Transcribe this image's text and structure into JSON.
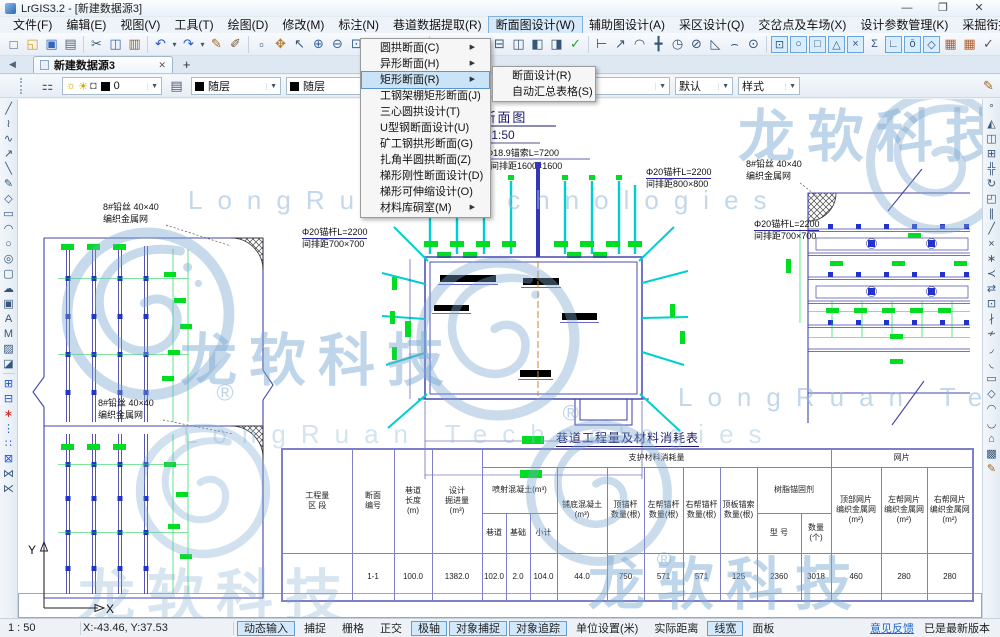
{
  "window": {
    "title": "LrGIS3.2 - [新建数据源3]",
    "min": "—",
    "max": "❐",
    "close": "✕"
  },
  "menubar": [
    {
      "n": "menu-file",
      "label": "文件(F)"
    },
    {
      "n": "menu-edit",
      "label": "编辑(E)"
    },
    {
      "n": "menu-view",
      "label": "视图(V)"
    },
    {
      "n": "menu-tools",
      "label": "工具(T)"
    },
    {
      "n": "menu-draw",
      "label": "绘图(D)"
    },
    {
      "n": "menu-modify",
      "label": "修改(M)"
    },
    {
      "n": "menu-dimension",
      "label": "标注(N)"
    },
    {
      "n": "menu-tunnel-data-extract",
      "label": "巷道数据提取(R)"
    },
    {
      "n": "menu-section-design",
      "label": "断面图设计(W)",
      "on": true
    },
    {
      "n": "menu-auxiliary-design",
      "label": "辅助图设计(A)"
    },
    {
      "n": "menu-mining-area-design",
      "label": "采区设计(Q)"
    },
    {
      "n": "menu-junction-yard",
      "label": "交岔点及车场(X)"
    },
    {
      "n": "menu-design-params",
      "label": "设计参数管理(K)"
    },
    {
      "n": "menu-mining-link-system",
      "label": "采掘衔接系统(F)"
    },
    {
      "n": "menu-help",
      "label": "帮助(H)"
    }
  ],
  "dropdown": {
    "items": [
      {
        "n": "menu-item-round-arch-section",
        "label": "圆拱断面(C)",
        "arrow": true
      },
      {
        "n": "menu-item-special-section",
        "label": "异形断面(H)",
        "arrow": true
      },
      {
        "n": "menu-item-rect-section",
        "label": "矩形断面(R)",
        "arrow": true,
        "on": true
      },
      {
        "n": "menu-item-steel-shed-rect-section",
        "label": "工钢架棚矩形断面(J)"
      },
      {
        "n": "menu-item-three-center-arch",
        "label": "三心圆拱设计(T)"
      },
      {
        "n": "menu-item-u-steel-section",
        "label": "U型钢断面设计(U)"
      },
      {
        "n": "menu-item-mine-steel-arch",
        "label": "矿工钢拱形断面(G)"
      },
      {
        "n": "menu-item-corner-semicircle-arch",
        "label": "扎角半圆拱断面(Z)"
      },
      {
        "n": "menu-item-trapezoid-rigid",
        "label": "梯形刚性断面设计(D)"
      },
      {
        "n": "menu-item-trapezoid-telescopic",
        "label": "梯形可伸缩设计(O)"
      },
      {
        "n": "menu-item-material-chamber",
        "label": "材料库硐室(M)",
        "arrow": true
      }
    ]
  },
  "submenu": {
    "items": [
      {
        "n": "submenu-item-section-design",
        "label": "断面设计(R)"
      },
      {
        "n": "submenu-item-auto-summary-table",
        "label": "自动汇总表格(S)"
      }
    ]
  },
  "toolbar1": [
    {
      "n": "new-file-icon",
      "g": "□"
    },
    {
      "n": "open-file-icon",
      "g": "◱",
      "c": "#d8a020"
    },
    {
      "n": "save-icon",
      "g": "▣",
      "c": "#3366bb"
    },
    {
      "n": "print-icon",
      "g": "▤",
      "c": "#556677"
    },
    {
      "sep": true
    },
    {
      "n": "cut-icon",
      "g": "✂"
    },
    {
      "n": "copy-icon",
      "g": "◫",
      "c": "#3366bb"
    },
    {
      "n": "paste-icon",
      "g": "▥",
      "c": "#886633"
    },
    {
      "sep": true
    },
    {
      "n": "undo-icon",
      "g": "↶",
      "c": "#2255cc"
    },
    {
      "n": "undo-arrow-icon",
      "g": "▾",
      "sm": true
    },
    {
      "n": "redo-icon",
      "g": "↷",
      "c": "#2255cc"
    },
    {
      "n": "redo-arrow-icon",
      "g": "▾",
      "sm": true
    },
    {
      "n": "format-brush-icon",
      "g": "✎",
      "c": "#996622"
    },
    {
      "n": "sketch-brush-icon",
      "g": "✐",
      "c": "#775533"
    }
  ],
  "toolbar2": [
    {
      "n": "select-window-icon",
      "g": "▫"
    },
    {
      "n": "pan-icon",
      "g": "✥",
      "c": "#b08030"
    },
    {
      "n": "pointer-icon",
      "g": "↖"
    },
    {
      "n": "zoom-in-icon",
      "g": "⊕",
      "c": "#336699"
    },
    {
      "n": "zoom-out-icon",
      "g": "⊖",
      "c": "#336699"
    },
    {
      "n": "zoom-window-icon",
      "g": "⊡",
      "c": "#336699"
    },
    {
      "n": "zoom-actual-icon",
      "g": "1:1",
      "txt": true
    },
    {
      "n": "previous-view-icon",
      "g": "↺",
      "c": "#2255cc"
    },
    {
      "n": "next-view-icon",
      "g": "↻",
      "c": "#2255cc"
    }
  ],
  "toolbar3": [
    {
      "n": "lamp-icon",
      "g": "◉",
      "c": "#cc8800"
    },
    {
      "n": "bulldozer-icon",
      "g": "◢",
      "c": "#e0a000"
    },
    {
      "n": "window-tile-icon",
      "g": "⊞"
    },
    {
      "n": "window-cascade-icon",
      "g": "⊟"
    },
    {
      "n": "window-split-icon",
      "g": "◫"
    },
    {
      "n": "window-left-icon",
      "g": "◧"
    },
    {
      "n": "window-right-icon",
      "g": "◨"
    },
    {
      "n": "edit-confirm-icon",
      "g": "✓",
      "c": "#2a9a2a"
    }
  ],
  "toolbar4": [
    {
      "n": "beam-section-icon",
      "g": "⊢"
    },
    {
      "n": "node-polyline-icon",
      "g": "↗"
    },
    {
      "n": "node-curve-icon",
      "g": "◠"
    },
    {
      "n": "axis-cross-icon",
      "g": "╋"
    },
    {
      "n": "clock-icon",
      "g": "◷"
    },
    {
      "n": "circle-slash-icon",
      "g": "⊘"
    },
    {
      "n": "angle-icon",
      "g": "◺"
    },
    {
      "n": "arc-point-icon",
      "g": "⌢"
    },
    {
      "n": "center-point-icon",
      "g": "⊙"
    }
  ],
  "osnap": [
    {
      "n": "osnap-endpoint-icon",
      "g": "⊡",
      "on": true
    },
    {
      "n": "osnap-circle-icon",
      "g": "○",
      "on": true
    },
    {
      "n": "osnap-midpoint-icon",
      "g": "□",
      "on": true
    },
    {
      "n": "osnap-node-icon",
      "g": "△",
      "on": true
    },
    {
      "n": "osnap-intersection-icon",
      "g": "×",
      "on": true
    },
    {
      "n": "osnap-extension-icon",
      "g": "Σ"
    },
    {
      "n": "osnap-perpendicular-icon",
      "g": "∟",
      "on": true
    },
    {
      "n": "osnap-tangent-icon",
      "g": "ō",
      "on": true
    },
    {
      "n": "osnap-quadrant-icon",
      "g": "◇",
      "on": true
    }
  ],
  "toolbar6": [
    {
      "n": "grid-settings-icon",
      "g": "▦",
      "c": "#b06030"
    },
    {
      "n": "grid-settings2-icon",
      "g": "▦",
      "c": "#b06030"
    },
    {
      "n": "confirm-icon",
      "g": "✓",
      "c": "#556"
    },
    {
      "sep": true
    },
    {
      "n": "info-icon",
      "g": "ⓘ",
      "on": true,
      "c": "#2255cc"
    }
  ],
  "lefttools": [
    {
      "n": "tool-line-icon",
      "g": "╱"
    },
    {
      "n": "tool-polyline-icon",
      "g": "≀"
    },
    {
      "n": "tool-spline-icon",
      "g": "∿"
    },
    {
      "n": "tool-ray-icon",
      "g": "↗"
    },
    {
      "n": "tool-segment-icon",
      "g": "╲"
    },
    {
      "n": "tool-sketch-icon",
      "g": "✎"
    },
    {
      "n": "tool-polygon-icon",
      "g": "◇"
    },
    {
      "n": "tool-rectangle-icon",
      "g": "▭"
    },
    {
      "n": "tool-arc-icon",
      "g": "◠"
    },
    {
      "n": "tool-circle-icon",
      "g": "○"
    },
    {
      "n": "tool-ellipse-icon",
      "g": "◎"
    },
    {
      "n": "tool-rounded-rect-icon",
      "g": "▢"
    },
    {
      "n": "tool-revision-cloud-icon",
      "g": "☁"
    },
    {
      "n": "tool-image-icon",
      "g": "▣"
    },
    {
      "n": "tool-text-icon",
      "g": "A"
    },
    {
      "n": "tool-mtext-icon",
      "g": "M"
    },
    {
      "n": "tool-hatch-icon",
      "g": "▨"
    },
    {
      "n": "tool-gradient-icon",
      "g": "◪"
    },
    {
      "sep": true
    },
    {
      "n": "tool-block-icon",
      "g": "⊞",
      "c": "#2255cc"
    },
    {
      "n": "tool-block-edit-icon",
      "g": "⊟",
      "c": "#2255cc"
    },
    {
      "n": "tool-point-icon",
      "g": "∗",
      "c": "#cc2222"
    },
    {
      "n": "tool-divide-icon",
      "g": "⋮",
      "c": "#2255cc"
    },
    {
      "n": "tool-measure-icon",
      "g": "∷",
      "c": "#2255cc"
    },
    {
      "n": "tool-table-icon",
      "g": "⊠",
      "c": "#2255cc"
    },
    {
      "n": "tool-join-icon",
      "g": "⋈"
    },
    {
      "n": "tool-fit-icon",
      "g": "⋉"
    }
  ],
  "righttools": [
    {
      "n": "tool-match-icon",
      "g": "°"
    },
    {
      "n": "tool-mirror-icon",
      "g": "◭"
    },
    {
      "n": "tool-copy-object-icon",
      "g": "◫"
    },
    {
      "n": "tool-array-icon",
      "g": "⊞"
    },
    {
      "n": "tool-move-icon",
      "g": "╬"
    },
    {
      "n": "tool-rotate-icon",
      "g": "↻"
    },
    {
      "n": "tool-scale-icon",
      "g": "◰"
    },
    {
      "n": "tool-offset-icon",
      "g": "∥"
    },
    {
      "n": "tool-edit-vertex-icon",
      "g": "╱"
    },
    {
      "n": "tool-trim-icon",
      "g": "×"
    },
    {
      "n": "tool-extend-icon",
      "g": "∗"
    },
    {
      "n": "tool-lengthen-icon",
      "g": "≺"
    },
    {
      "n": "tool-stretch-icon",
      "g": "⇄"
    },
    {
      "n": "tool-crop-icon",
      "g": "⊡"
    },
    {
      "n": "tool-break-icon",
      "g": "∤"
    },
    {
      "n": "tool-break-point-icon",
      "g": "≁"
    },
    {
      "n": "tool-fillet-icon",
      "g": "◞"
    },
    {
      "n": "tool-chamfer-icon",
      "g": "◟"
    },
    {
      "n": "tool-rect-edit-icon",
      "g": "▭"
    },
    {
      "n": "tool-polygon-edit-icon",
      "g": "◇"
    },
    {
      "n": "tool-arc-edit-icon",
      "g": "◠"
    },
    {
      "n": "tool-curve-edit-icon",
      "g": "◡"
    },
    {
      "n": "tool-solid-icon",
      "g": "⌂"
    },
    {
      "n": "tool-hatch-edit-icon",
      "g": "▩"
    },
    {
      "n": "tool-brush-icon",
      "g": "✎",
      "c": "#996622"
    }
  ],
  "tabs": {
    "scroll_left": "◀",
    "active": "新建数据源3",
    "close": "✕",
    "new_tab": "+"
  },
  "props": {
    "layer_value": "0",
    "color_value": "随层",
    "color2_value": "随层",
    "linetype_value": "随层",
    "lineweight_value": "默认",
    "style_value": "样式"
  },
  "drawing": {
    "section_title": "1-1 断面图",
    "section_scale": "M 1:50",
    "cable_spec": "Φ18.9锚索L=7200",
    "cable_spacing": "间排距1600×1600",
    "bolt_spec": "Φ20锚杆L=2200",
    "bolt_spacing_800": "间排距800×800",
    "bolt_spacing_700": "间排距700×700",
    "mesh_line1": "8#铅丝 40×40",
    "mesh_line2": "编织金属网"
  },
  "table": {
    "title": "巷道工程量及材料消耗表",
    "h_qty": "工程量\n区 段",
    "h_sec": "断面\n编号",
    "h_len": "巷道\n长度\n(m)",
    "h_vol": "设计\n掘进量\n(m³)",
    "h_support": "支护材料消耗量",
    "h_mesh": "网片",
    "h_shotcrete": "喷射混凝土(m³)",
    "h_sc_tunnel": "巷道",
    "h_sc_base": "基础",
    "h_sc_sum": "小计",
    "h_floor": "铺底混凝土\n(m³)",
    "h_top_bolt": "顶锚杆\n数量(根)",
    "h_left_bolt": "左帮锚杆\n数量(根)",
    "h_right_bolt": "右帮锚杆\n数量(根)",
    "h_cable": "顶板锚索\n数量(根)",
    "h_resin": "树脂锚固剂",
    "h_resin_model": "型 号",
    "h_resin_qty": "数量\n(个)",
    "h_mesh_top": "顶部网片\n编织金属网\n(m²)",
    "h_mesh_left": "左帮网片\n编织金属网\n(m²)",
    "h_mesh_right": "右帮网片\n编织金属网\n(m²)",
    "row": {
      "qty": "",
      "sec": "1-1",
      "len": "100.0",
      "vol": "1382.0",
      "sc_tunnel": "102.0",
      "sc_base": "2.0",
      "sc_sum": "104.0",
      "floor": "44.0",
      "top_bolt": "750",
      "left_bolt": "571",
      "right_bolt": "571",
      "cable": "125",
      "resin_model": "2360",
      "resin_qty": "3018",
      "mesh_top": "460",
      "mesh_left": "280",
      "mesh_right": "280"
    }
  },
  "statusbar": {
    "scale": "1 : 50",
    "coords": "X:-43.46, Y:37.53",
    "toggles": [
      {
        "n": "toggle-dynamic-input",
        "label": "动态输入",
        "on": true
      },
      {
        "n": "toggle-snap",
        "label": "捕捉"
      },
      {
        "n": "toggle-grid",
        "label": "栅格"
      },
      {
        "n": "toggle-ortho",
        "label": "正交"
      },
      {
        "n": "toggle-polar",
        "label": "极轴",
        "on": true
      },
      {
        "n": "toggle-osnap",
        "label": "对象捕捉",
        "on": true
      },
      {
        "n": "toggle-otrack",
        "label": "对象追踪",
        "on": true
      },
      {
        "n": "toggle-units",
        "label": "单位设置(米)"
      },
      {
        "n": "toggle-actual-distance",
        "label": "实际距离"
      },
      {
        "n": "toggle-lineweight",
        "label": "线宽",
        "on": true
      },
      {
        "n": "toggle-panel",
        "label": "面板"
      }
    ],
    "feedback": "意见反馈",
    "version": "已是最新版本"
  },
  "watermark": {
    "cn": "龙软科技",
    "en": "LongRuan Technologies"
  },
  "axes": {
    "x": "X",
    "y": "Y"
  },
  "colors": {
    "accent": "#3a3aae",
    "cyan": "#00cfcf",
    "green": "#00dd22",
    "blue_sq": "#2233cc",
    "wm": "#7aa8d0",
    "table_border": "#8080c8"
  }
}
